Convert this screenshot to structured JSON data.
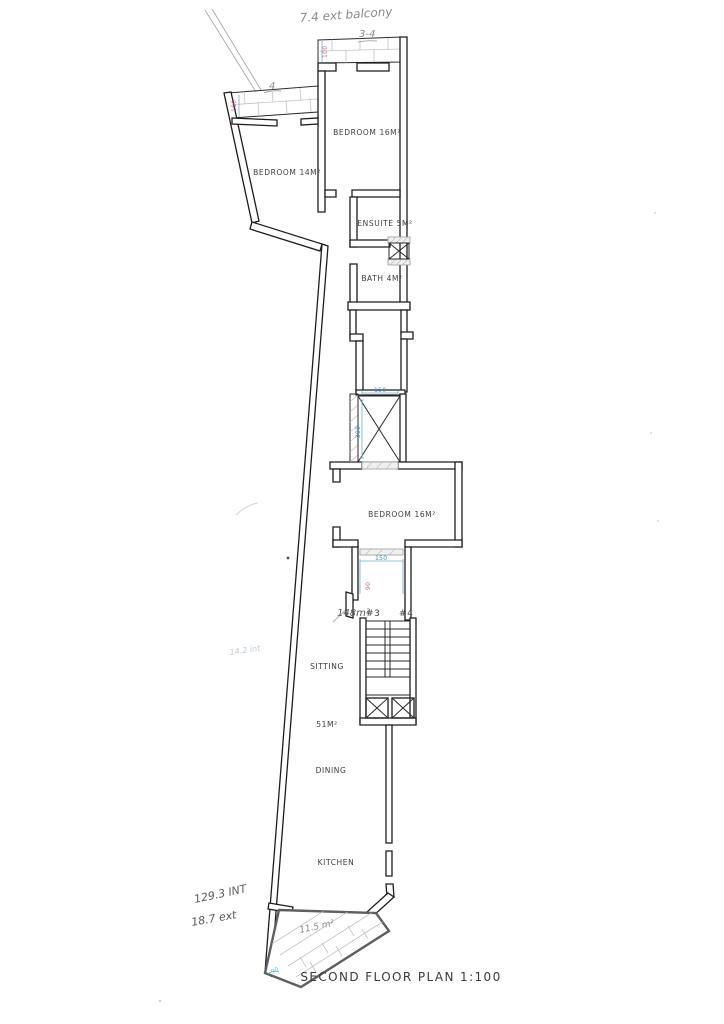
{
  "document": {
    "title": "SECOND FLOOR PLAN 1:100",
    "type_note": "hand-drawn architectural floor plan, scanned"
  },
  "rooms": [
    {
      "name": "bedroom-16-top",
      "label": "BEDROOM 16M²"
    },
    {
      "name": "bedroom-14",
      "label": "BEDROOM 14M²"
    },
    {
      "name": "ensuite",
      "label": "ENSUITE 5M²"
    },
    {
      "name": "bath",
      "label": "BATH 4M²"
    },
    {
      "name": "bedroom-16-mid",
      "label": "BEDROOM 16M²"
    },
    {
      "name": "sitting",
      "label": "SITTING"
    },
    {
      "name": "sitting-area",
      "label": "51M²"
    },
    {
      "name": "dining",
      "label": "DINING"
    },
    {
      "name": "kitchen",
      "label": "KITCHEN"
    }
  ],
  "notes": [
    {
      "name": "ext-balcony-note",
      "text": "7.4 ext balcony"
    },
    {
      "name": "top-balcony-width",
      "text": "3-4"
    },
    {
      "name": "left-balcony-width",
      "text": "4"
    },
    {
      "name": "unit-area-note",
      "text": "148m²"
    },
    {
      "name": "unit-number-3",
      "text": "#3"
    },
    {
      "name": "unit-number-4",
      "text": "#4"
    },
    {
      "name": "terrace-area-note",
      "text": "11.5 m²"
    },
    {
      "name": "internal-area-note",
      "text": "129.3 INT"
    },
    {
      "name": "external-area-note",
      "text": "18.7 ext"
    },
    {
      "name": "faint-area-note",
      "text": "14.2 int"
    }
  ],
  "dimensions": {
    "blue": [
      {
        "name": "lift-width",
        "text": "150"
      },
      {
        "name": "lift-depth",
        "text": "300"
      },
      {
        "name": "corridor-width",
        "text": "150"
      },
      {
        "name": "terrace-door-width",
        "text": "90"
      }
    ],
    "pink": [
      {
        "name": "top-balcony-depth",
        "text": "100"
      },
      {
        "name": "left-balcony-depth",
        "text": "100"
      },
      {
        "name": "corridor-door-width",
        "text": "90"
      }
    ]
  },
  "colors": {
    "wall": "#1c1c1c",
    "pencil": "#8a8a8a",
    "dimension_blue": "#3f8fbf",
    "dimension_pink": "#c2628e",
    "terrace_outline": "#5f5f5f",
    "paper": "#ffffff"
  }
}
